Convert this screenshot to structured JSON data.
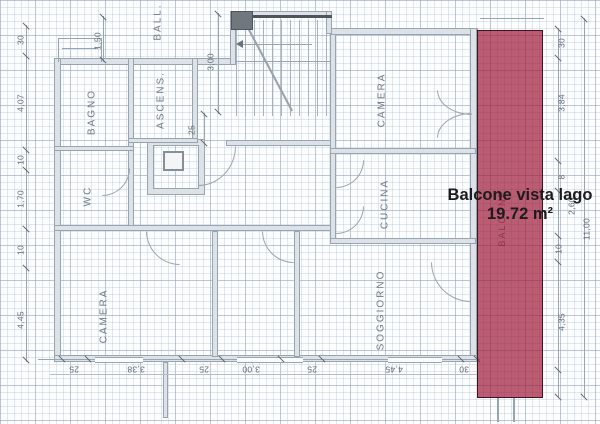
{
  "image_type": "apartment floor plan with highlighted balcony",
  "overlay": {
    "line1": "Balcone vista lago",
    "line2": "19.72 m²"
  },
  "rooms": {
    "bagno": "BAGNO",
    "wc": "WC",
    "ascensore": "ASCENS.",
    "ballatoio": "BALL.",
    "camera_nord": "CAMERA",
    "camera_sud": "CAMERA",
    "cucina": "CUCINA",
    "soggiorno": "SOGGIORNO",
    "balcone": "BALCONE"
  },
  "dimensions": {
    "labels": [
      {
        "t": "30",
        "x": 21,
        "y": 40,
        "r": -90
      },
      {
        "t": "4,07",
        "x": 21,
        "y": 103,
        "r": -90
      },
      {
        "t": "10",
        "x": 21,
        "y": 160,
        "r": -90
      },
      {
        "t": "1,70",
        "x": 21,
        "y": 199,
        "r": -90
      },
      {
        "t": "10",
        "x": 21,
        "y": 250,
        "r": -90
      },
      {
        "t": "4,45",
        "x": 21,
        "y": 320,
        "r": -90
      },
      {
        "t": "1,50",
        "x": 98,
        "y": 41,
        "r": -90
      },
      {
        "t": "3,00",
        "x": 211,
        "y": 62,
        "r": -90
      },
      {
        "t": "25",
        "x": 192,
        "y": 130,
        "r": -90
      },
      {
        "t": "30",
        "x": 562,
        "y": 43,
        "r": -90
      },
      {
        "t": "3,84",
        "x": 562,
        "y": 103,
        "r": -90
      },
      {
        "t": "8",
        "x": 562,
        "y": 177,
        "r": -90
      },
      {
        "t": "10",
        "x": 559,
        "y": 249,
        "r": -90
      },
      {
        "t": "4,35",
        "x": 562,
        "y": 322,
        "r": -90
      },
      {
        "t": "2,60",
        "x": 572,
        "y": 206,
        "r": -90
      },
      {
        "t": "11,00",
        "x": 587,
        "y": 229,
        "r": -90
      },
      {
        "t": "25",
        "x": 74,
        "y": 369,
        "r": 180
      },
      {
        "t": "3,38",
        "x": 136,
        "y": 369,
        "r": 180
      },
      {
        "t": "25",
        "x": 204,
        "y": 369,
        "r": 180
      },
      {
        "t": "3,00",
        "x": 251,
        "y": 369,
        "r": 180
      },
      {
        "t": "25",
        "x": 312,
        "y": 369,
        "r": 180
      },
      {
        "t": "4,45",
        "x": 394,
        "y": 369,
        "r": 180
      },
      {
        "t": "30",
        "x": 464,
        "y": 369,
        "r": 180
      }
    ]
  },
  "colors": {
    "highlight_fill": "rgba(158,24,56,0.70)",
    "highlight_border": "#42101e",
    "wall_fill": "#dce2e8",
    "wall_edge": "#98a4b0",
    "dim_text": "#5f6974",
    "room_text": "#6e7882",
    "overlay_text": "#1c1c1c"
  }
}
